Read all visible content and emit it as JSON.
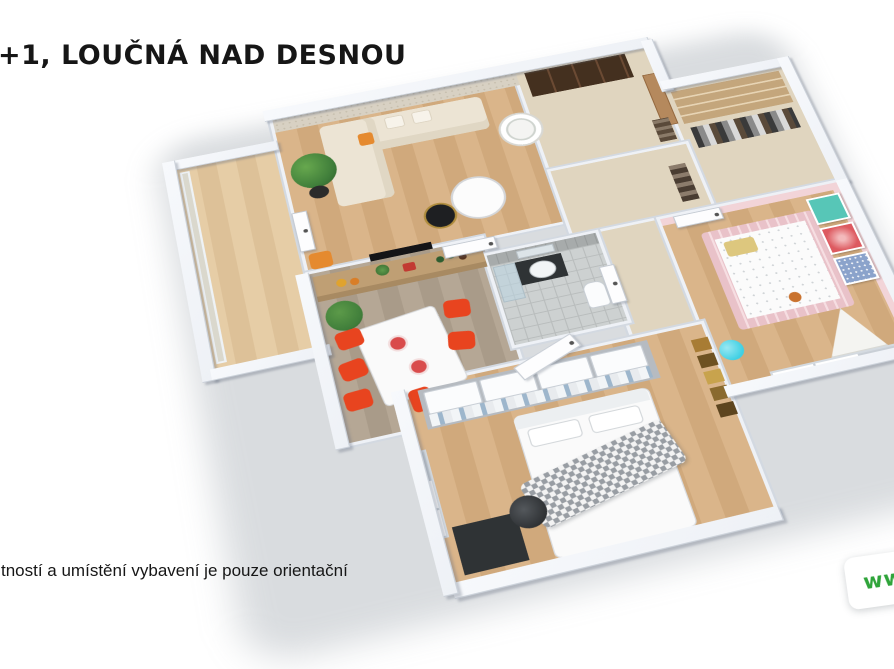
{
  "title": {
    "text": "+1, LOUČNÁ NAD DESNOU",
    "note": "left edge of heading clipped by image border"
  },
  "disclaimer": {
    "text": "tností a umístění vybavení je pouze orientační",
    "note": "left edge clipped by image border"
  },
  "watermark": {
    "text": "www",
    "card_color": "#ffffff"
  },
  "floorplan": {
    "type": "3d-isometric-apartment-render",
    "rooms": [
      {
        "name": "balcony",
        "floor": "light-oak-planks",
        "features": [
          "glazed-railing",
          "windows"
        ]
      },
      {
        "name": "living-room",
        "floor": "oak-planks",
        "features": [
          "patterned-wallpaper-wall",
          "cream-corner-sofa",
          "orange-accent-pillow",
          "potted-plant",
          "white-round-coffee-table",
          "black-round-side-table",
          "round-shelf-tower",
          "wall-tv"
        ]
      },
      {
        "name": "entry-hall",
        "floor": "beige",
        "features": [
          "dark-brown-wardrobe",
          "wooden-front-door",
          "coat-rack"
        ]
      },
      {
        "name": "walk-in-closet",
        "floor": "beige",
        "features": [
          "tan-shelving",
          "hanging-clothes"
        ]
      },
      {
        "name": "kitchen-dining",
        "floor": "grey-wood-planks",
        "features": [
          "kitchen-counter-with-bottles-and-fruit",
          "white-dining-table",
          "red-chairs",
          "tall-plant"
        ]
      },
      {
        "name": "bathroom",
        "floor": "grey-tile",
        "features": [
          "grey-tiled-walls",
          "dark-vanity-with-sink",
          "mirror",
          "shower",
          "toilet"
        ]
      },
      {
        "name": "hallway",
        "floor": "beige",
        "features": [
          "coat-rack-with-clothes"
        ]
      },
      {
        "name": "nursery",
        "floor": "oak-planks",
        "features": [
          "pink-walls",
          "pink-cot-with-white-mattress",
          "wall-art-teal",
          "wall-art-red",
          "wall-art-blue",
          "cyan-lamp",
          "white-teepee",
          "windows"
        ]
      },
      {
        "name": "bedroom",
        "floor": "oak-planks",
        "features": [
          "double-bed-white",
          "checked-grey-throw",
          "open-wardrobe-white-boxes",
          "hanging-shirts",
          "black-desk",
          "black-office-chair",
          "gallery-picture-wall",
          "windows"
        ]
      }
    ],
    "palette": {
      "ink": "#161616",
      "watermark_green": "#2fa43a",
      "wall": "#eef1f6",
      "wall_edge": "#ccd2da",
      "wallpaper": "#d8d1c3",
      "oak": "#dab58a",
      "oak_dark": "#d0a97c",
      "grey_wood": "#b5a795",
      "grey_wood_dark": "#a99b89",
      "beige_floor": "#e0d5bf",
      "tile_floor": "#cdd1d1",
      "tile_wall": "#a7abab",
      "sofa": "#ece4d4",
      "pillow_orange": "#e58a2f",
      "chair_red": "#e8441f",
      "table_white": "#fafafa",
      "counter": "#bf9f74",
      "shelf_tan": "#c4a67c",
      "dark_wardrobe": "#44301f",
      "wood_door": "#b5895d",
      "pink_wall": "#f2d4d8",
      "crib_pink": "#e9c2c9",
      "art_teal": "#57c6b7",
      "art_red": "#dd5a60",
      "art_blue": "#8ba3cb",
      "lamp_cyan": "#3fd0e4",
      "plant_green": "#3f7d3a",
      "blanket": "#989da3",
      "desk_black": "#2f3335"
    }
  }
}
